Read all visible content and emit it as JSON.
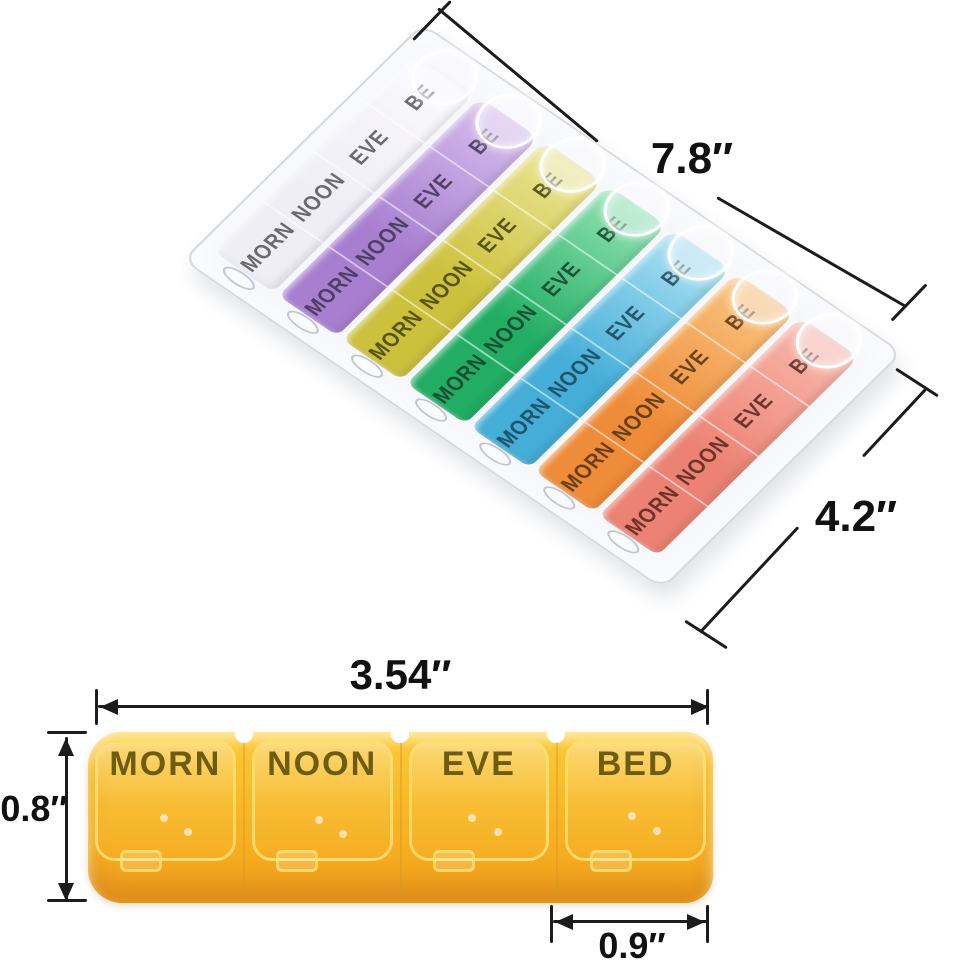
{
  "canvas": {
    "background": "#ffffff",
    "line_color": "#1c1c1c"
  },
  "weekly_organizer": {
    "description": "7-day 28-compartment pill organizer, angled open-lid view",
    "row_labels": [
      "MORN",
      "NOON",
      "EVE",
      "BE"
    ],
    "rows": [
      {
        "name": "day-1",
        "color_start": "#efedf6",
        "color_end": "#fbfafd",
        "text_color": "#53535c"
      },
      {
        "name": "day-2",
        "color_start": "#a87fd0",
        "color_end": "#d6bdec",
        "text_color": "#3f3450"
      },
      {
        "name": "day-3",
        "color_start": "#ccc13c",
        "color_end": "#ebe594",
        "text_color": "#45400f"
      },
      {
        "name": "day-4",
        "color_start": "#21ad63",
        "color_end": "#93e3b4",
        "text_color": "#143f28"
      },
      {
        "name": "day-5",
        "color_start": "#44add8",
        "color_end": "#abe1f2",
        "text_color": "#1c4457"
      },
      {
        "name": "day-6",
        "color_start": "#ef8c39",
        "color_end": "#f9c480",
        "text_color": "#54320f"
      },
      {
        "name": "day-7",
        "color_start": "#ec8273",
        "color_end": "#f8b8ad",
        "text_color": "#57261d"
      }
    ],
    "dim_length": {
      "label": "7.8″"
    },
    "dim_width": {
      "label": "4.2″"
    }
  },
  "single_strip": {
    "description": "single day strip, yellow",
    "cells": [
      "MORN",
      "NOON",
      "EVE",
      "BED"
    ],
    "text_color": "#6e5c13",
    "body_color_top": "#fbc93a",
    "body_color_bottom": "#ec9c1f",
    "dim_length": {
      "label": "3.54″"
    },
    "dim_height": {
      "label": "0.8″"
    },
    "dim_cell": {
      "label": "0.9″"
    }
  }
}
